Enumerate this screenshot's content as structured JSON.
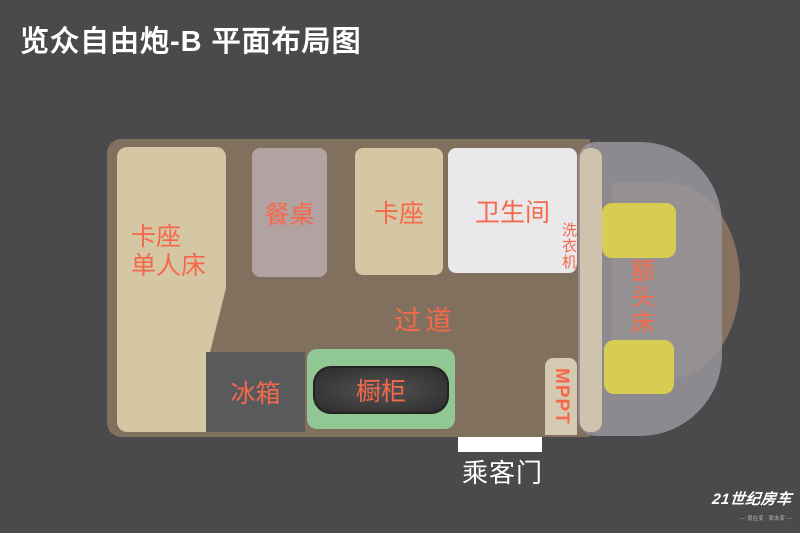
{
  "title": "览众自由炮-B 平面布局图",
  "colors": {
    "background": "#4a4a4c",
    "body_brown": "#82705f",
    "block_beige": "#d5c6a4",
    "table_mauve": "#b2a3a2",
    "bathroom_white": "#e9e8ea",
    "fridge_gray": "#595a5c",
    "cabinet_green": "#90c795",
    "seat_yellow": "#d7cd52",
    "partition_beige": "#cfc3ae",
    "label_orange": "#f5694a"
  },
  "floorplan": {
    "bed": {
      "line1": "卡座",
      "line2": "单人床"
    },
    "dining_table": "餐桌",
    "booth": "卡座",
    "bathroom": "卫生间",
    "washer": "洗衣机",
    "aisle": "过道",
    "fridge": "冰箱",
    "cabinet": "橱柜",
    "mppt": "MPPT",
    "overhead_bed": "额头床",
    "passenger_door": "乘客门"
  },
  "logo": {
    "brand": "21世纪房车",
    "tagline": "— 景在变 · 家未变 —"
  }
}
